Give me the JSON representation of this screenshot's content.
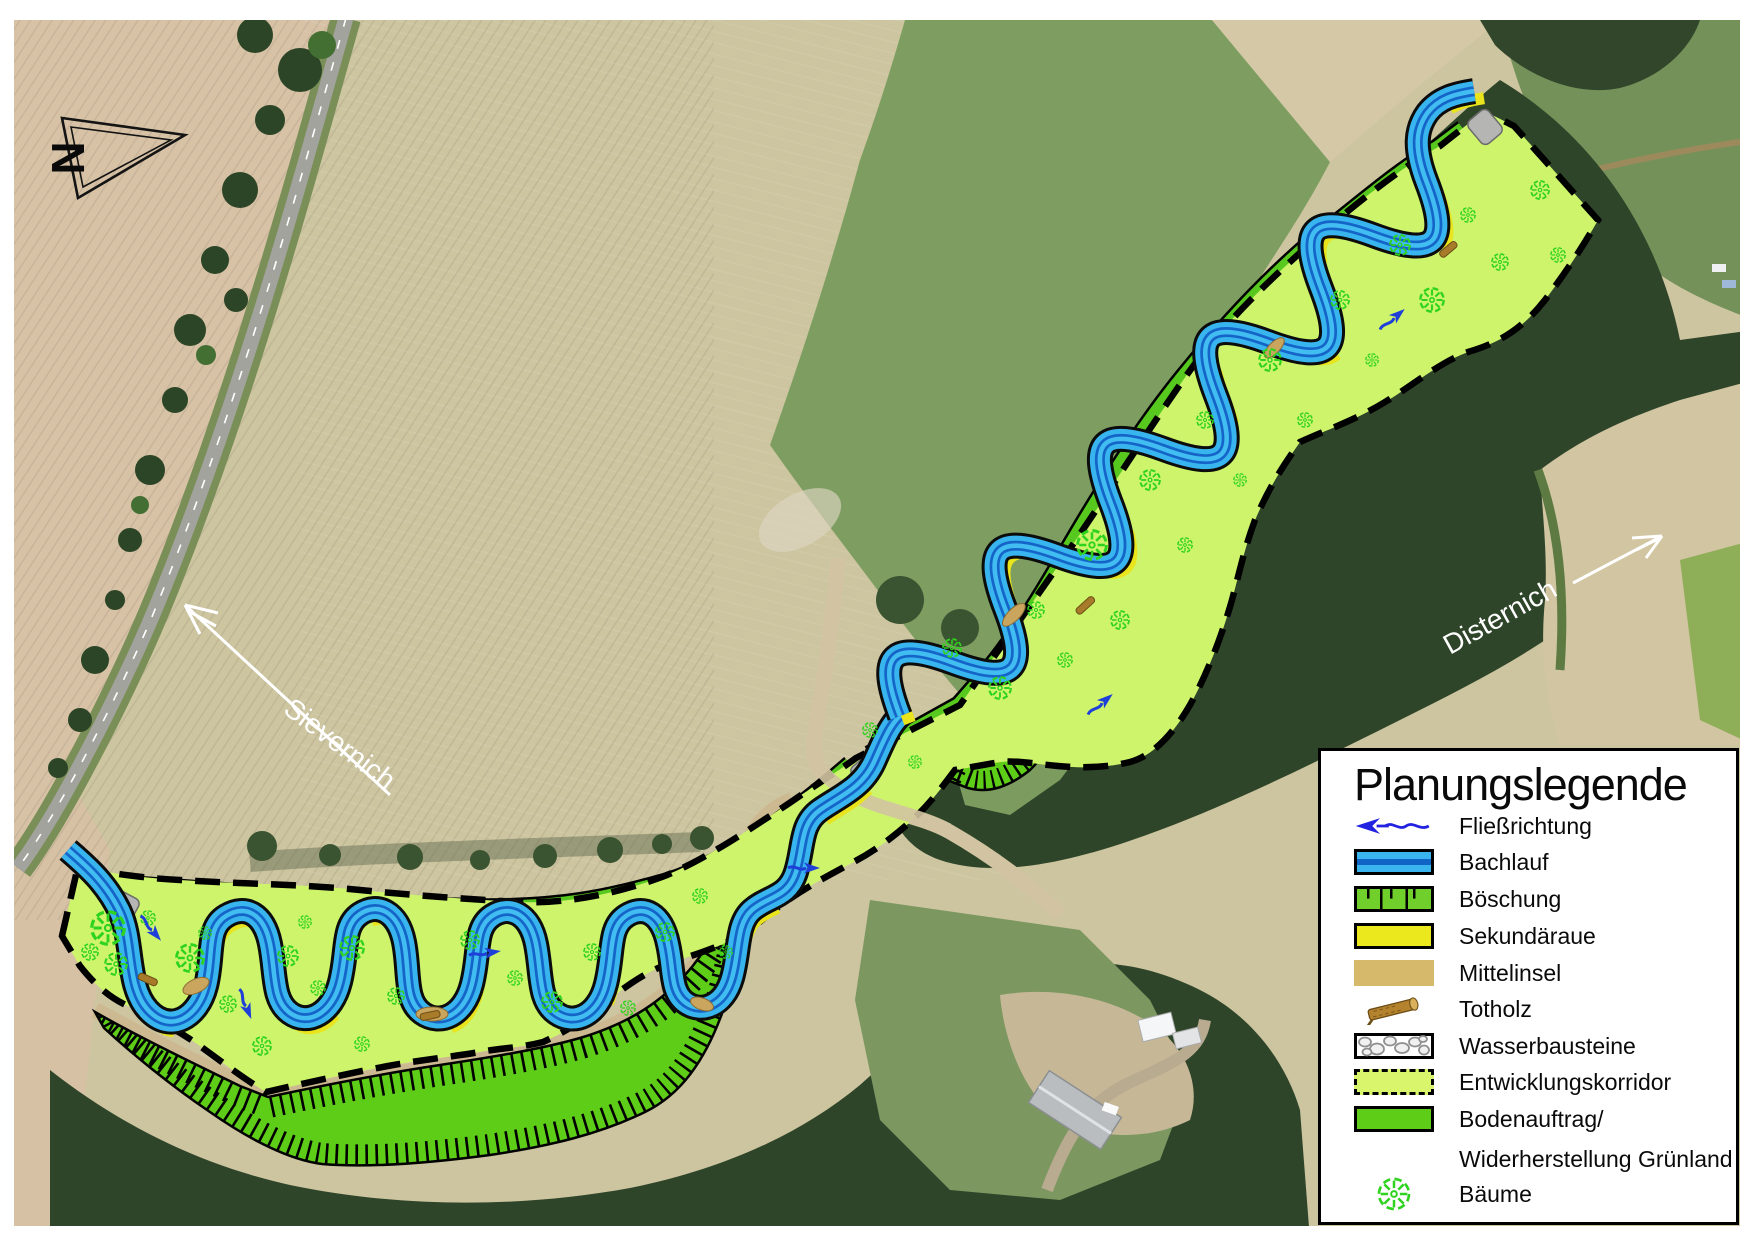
{
  "map": {
    "north_label": "N",
    "labels": {
      "west_village": "Sievernich",
      "east_village": "Disternich"
    },
    "colors": {
      "corridor": "#cdf46a",
      "bodenauftrag_green": "#5ecd18",
      "stream_light_blue": "#38b4ee",
      "stream_dark_blue": "#1565c8",
      "sekundaeraue_yellow": "#ece81e",
      "mittelinsel_tan": "#d6b96a",
      "tree_green": "#2ed31e",
      "flow_arrow_blue": "#2222e0"
    }
  },
  "legend": {
    "title": "Planungslegende",
    "items": [
      {
        "id": "fliessrichtung",
        "label": "Fließrichtung"
      },
      {
        "id": "bachlauf",
        "label": "Bachlauf"
      },
      {
        "id": "boeschung",
        "label": "Böschung"
      },
      {
        "id": "sekundaeraue",
        "label": "Sekundäraue"
      },
      {
        "id": "mittelinsel",
        "label": "Mittelinsel"
      },
      {
        "id": "totholz",
        "label": "Totholz"
      },
      {
        "id": "wasserbausteine",
        "label": "Wasserbausteine"
      },
      {
        "id": "entwicklungskorridor",
        "label": "Entwicklungskorridor"
      },
      {
        "id": "bodenauftrag",
        "label": "Bodenauftrag/",
        "label2": "Widerherstellung Grünland"
      },
      {
        "id": "baeume",
        "label": "Bäume"
      }
    ]
  }
}
